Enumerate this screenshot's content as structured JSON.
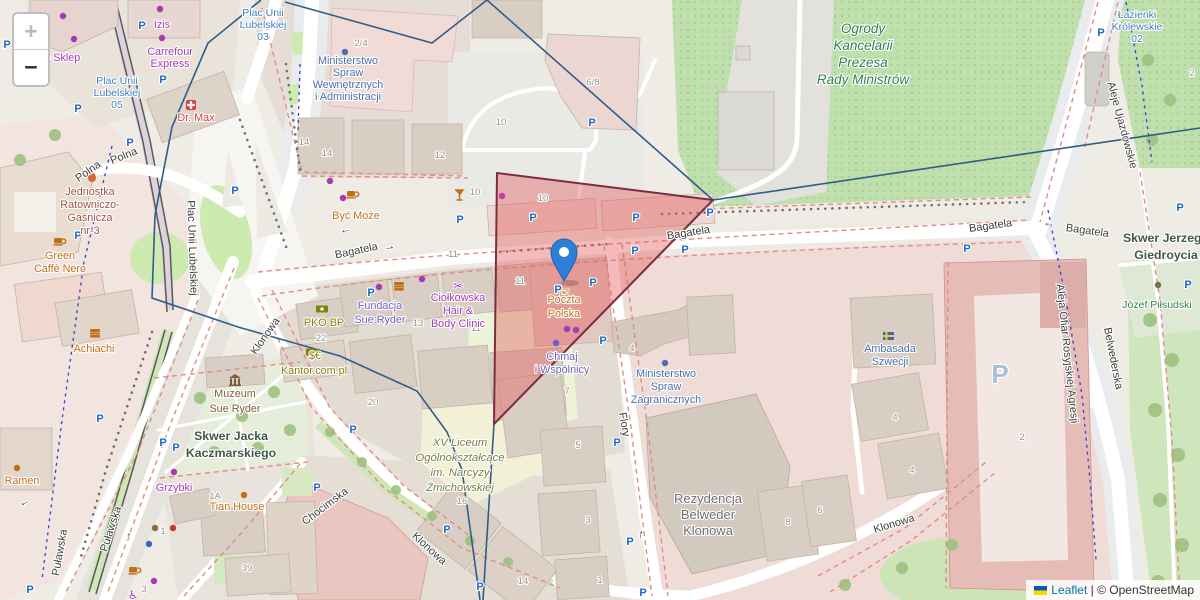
{
  "map": {
    "controls": {
      "zoom_in": "+",
      "zoom_out": "−"
    },
    "attribution": {
      "flag_icon": "ukraine-flag",
      "leaflet": "Leaflet",
      "separator": " | ",
      "osm": "© OpenStreetMap"
    },
    "marker": {
      "x": 564,
      "y": 281,
      "color": "#2e7fd6",
      "rim": "#1d62b4"
    },
    "red_polygon": {
      "points": "497,173 713,200 494,424",
      "fill": "#e25d5d",
      "fill_opacity": 0.42,
      "stroke": "#7c2d43"
    },
    "boundary": {
      "color": "#2f5d8a",
      "paths": [
        "M261,0 L208,43 L172,127 L155,215 L152,298 L238,327 L340,356 L417,391 L447,432 L462,470 L480,600",
        "M285,2 L432,43 L487,0",
        "M487,0 L713,200 L1200,128",
        "M713,200 L494,424 L483,600"
      ]
    },
    "labels": [
      {
        "lines": [
          "Plac Unii",
          "Lubelskiej",
          "03"
        ],
        "x": 263,
        "y": 16,
        "lh": 12,
        "cls": "transit"
      },
      {
        "lines": [
          "Plac Unii",
          "Lubelskiej",
          "05"
        ],
        "x": 117,
        "y": 84,
        "lh": 12,
        "cls": "transit"
      },
      {
        "lines": [
          "Łazienki",
          "Królewskie",
          "02"
        ],
        "x": 1137,
        "y": 18,
        "lh": 12,
        "cls": "transit"
      },
      {
        "t": "Zoo Sklep",
        "x": 56,
        "y": 61,
        "cls": "shop"
      },
      {
        "t": "Izis",
        "x": 162,
        "y": 28,
        "cls": "shop"
      },
      {
        "lines": [
          "Carrefour",
          "Express"
        ],
        "x": 170,
        "y": 55,
        "lh": 12,
        "cls": "shop"
      },
      {
        "lines": [
          "Fundacja",
          "Sue Ryder"
        ],
        "x": 380,
        "y": 309,
        "lh": 14,
        "cls": "office"
      },
      {
        "lines": [
          "Ciołkowska",
          "Hair &",
          "Body Clinic"
        ],
        "x": 458,
        "y": 301,
        "lh": 13,
        "cls": "shop"
      },
      {
        "t": "Grzybki",
        "x": 174,
        "y": 491,
        "cls": "shop"
      },
      {
        "lines": [
          "Chmaj",
          "i Wspólnicy"
        ],
        "x": 562,
        "y": 360,
        "lh": 13,
        "cls": "office"
      },
      {
        "t": "Być Może",
        "x": 356,
        "y": 219,
        "cls": "food"
      },
      {
        "lines": [
          "Green",
          "Caffè Nero"
        ],
        "x": 60,
        "y": 259,
        "lh": 13,
        "cls": "food"
      },
      {
        "t": "Achiachi",
        "x": 94,
        "y": 352,
        "cls": "food"
      },
      {
        "t": "Ramen",
        "x": 22,
        "y": 484,
        "cls": "food"
      },
      {
        "t": "Tian House",
        "x": 237,
        "y": 510,
        "cls": "food"
      },
      {
        "lines": [
          "Poczta",
          "Polska"
        ],
        "x": 564,
        "y": 303,
        "lh": 14,
        "cls": "food"
      },
      {
        "t": "PKO BP",
        "x": 324,
        "y": 326,
        "cls": "money"
      },
      {
        "t": "Kantor.com.pl",
        "x": 314,
        "y": 374,
        "cls": "money"
      },
      {
        "t": "$€",
        "x": 315,
        "y": 359,
        "cls": "money",
        "size": 9
      },
      {
        "t": "Dr. Max",
        "x": 196,
        "y": 121,
        "cls": "pharmacy"
      },
      {
        "lines": [
          "Jednostka",
          "Ratowniczo-",
          "Gaśnicza",
          "nr-3"
        ],
        "x": 90,
        "y": 195,
        "lh": 13,
        "cls": "fire"
      },
      {
        "lines": [
          "Ministerstwo",
          "Spraw",
          "Wewnętrznych",
          "i Administracji"
        ],
        "x": 348,
        "y": 64,
        "lh": 12,
        "cls": "gov"
      },
      {
        "lines": [
          "Ministerstwo",
          "Spraw",
          "Zagranicznych"
        ],
        "x": 666,
        "y": 377,
        "lh": 13,
        "cls": "gov"
      },
      {
        "lines": [
          "Ambasada",
          "Szwecji"
        ],
        "x": 890,
        "y": 352,
        "lh": 13,
        "cls": "gov"
      },
      {
        "lines": [
          "Ogrody",
          "Kancelarii",
          "Prezesa",
          "Rady Ministrów"
        ],
        "x": 863,
        "y": 33,
        "lh": 17,
        "cls": "parkbig"
      },
      {
        "t": "Józef Piłsudski",
        "x": 1157,
        "y": 308,
        "cls": "parksm"
      },
      {
        "lines": [
          "XV Liceum",
          "Ogólnokształcące",
          "im. Narcyzy",
          "Żmichowskiej"
        ],
        "x": 460,
        "y": 446,
        "lh": 15,
        "cls": "school"
      },
      {
        "lines": [
          "Skwer Jacka",
          "Kaczmarskiego"
        ],
        "x": 231,
        "y": 440,
        "lh": 17,
        "cls": "square"
      },
      {
        "lines": [
          "Skwer Jerzego",
          "Giedroycia"
        ],
        "x": 1166,
        "y": 242,
        "lh": 17,
        "cls": "square"
      },
      {
        "lines": [
          "Muzeum",
          "Sue Ryder"
        ],
        "x": 235,
        "y": 397,
        "lh": 15,
        "cls": "museum"
      },
      {
        "lines": [
          "Rezydencja",
          "Belweder",
          "Klonowa"
        ],
        "x": 708,
        "y": 503,
        "lh": 16,
        "cls": "residence"
      },
      {
        "t": "Polna",
        "x": 90,
        "y": 174,
        "rot": -35,
        "cls": "street"
      },
      {
        "t": "Polna",
        "x": 125,
        "y": 159,
        "rot": -22,
        "cls": "street"
      },
      {
        "t": "Plac Unii Lubelskiej",
        "x": 189,
        "y": 248,
        "rot": 88,
        "cls": "street"
      },
      {
        "t": "Bagatela",
        "x": 357,
        "y": 254,
        "rot": -12,
        "cls": "street"
      },
      {
        "t": "Bagatela",
        "x": 689,
        "y": 236,
        "rot": -9,
        "cls": "street"
      },
      {
        "t": "Bagatela",
        "x": 991,
        "y": 229,
        "rot": -8,
        "cls": "street"
      },
      {
        "t": "Bagatela",
        "x": 1087,
        "y": 234,
        "rot": 8,
        "cls": "street"
      },
      {
        "t": "Klonowa",
        "x": 268,
        "y": 338,
        "rot": -55,
        "cls": "street"
      },
      {
        "t": "Chocimska",
        "x": 327,
        "y": 509,
        "rot": -37,
        "cls": "street"
      },
      {
        "t": "Klonowa",
        "x": 427,
        "y": 551,
        "rot": 42,
        "cls": "street"
      },
      {
        "t": "Klonowa",
        "x": 895,
        "y": 527,
        "rot": -17,
        "cls": "street"
      },
      {
        "t": "Flory",
        "x": 621,
        "y": 425,
        "rot": 80,
        "cls": "street"
      },
      {
        "t": "Belwederska",
        "x": 1110,
        "y": 359,
        "rot": 79,
        "cls": "street"
      },
      {
        "t": "Aleje Ujazdowskie",
        "x": 1119,
        "y": 126,
        "rot": 75,
        "cls": "street"
      },
      {
        "t": "Aleja Ofiar Rosyjskiej Agresji",
        "x": 1064,
        "y": 354,
        "rot": 84,
        "cls": "street"
      },
      {
        "t": "Puławska",
        "x": 63,
        "y": 553,
        "rot": -80,
        "cls": "street"
      },
      {
        "t": "Puławska",
        "x": 114,
        "y": 530,
        "rot": -72,
        "cls": "street"
      },
      {
        "t": "→",
        "x": 390,
        "y": 250,
        "rot": -12,
        "cls": "arrow"
      },
      {
        "t": "←",
        "x": 346,
        "y": 233,
        "rot": -10,
        "cls": "arrow"
      },
      {
        "t": "←",
        "x": 1049,
        "y": 226,
        "cls": "arrow"
      },
      {
        "t": "←",
        "x": 26,
        "y": 505,
        "rot": -25,
        "cls": "arrow"
      },
      {
        "t": "↑",
        "x": 129,
        "y": 540,
        "cls": "arrow"
      },
      {
        "t": "↑",
        "x": 640,
        "y": 538,
        "rot": 12,
        "cls": "arrow"
      }
    ],
    "house_numbers": [
      {
        "t": "2/4",
        "x": 361,
        "y": 46
      },
      {
        "t": "14",
        "x": 304,
        "y": 145
      },
      {
        "t": "14",
        "x": 327,
        "y": 156
      },
      {
        "t": "12",
        "x": 440,
        "y": 158
      },
      {
        "t": "10",
        "x": 501,
        "y": 125
      },
      {
        "t": "6/8",
        "x": 593,
        "y": 85
      },
      {
        "t": "10",
        "x": 475,
        "y": 195
      },
      {
        "t": "10",
        "x": 543,
        "y": 201
      },
      {
        "t": "11",
        "x": 453,
        "y": 257
      },
      {
        "t": "11",
        "x": 520,
        "y": 284
      },
      {
        "t": "13",
        "x": 418,
        "y": 326
      },
      {
        "t": "11",
        "x": 476,
        "y": 331
      },
      {
        "t": "22",
        "x": 321,
        "y": 341
      },
      {
        "t": "20",
        "x": 373,
        "y": 405
      },
      {
        "t": "16",
        "x": 462,
        "y": 504
      },
      {
        "t": "1A",
        "x": 215,
        "y": 499
      },
      {
        "t": "1",
        "x": 163,
        "y": 534
      },
      {
        "t": "39",
        "x": 247,
        "y": 571
      },
      {
        "t": "3",
        "x": 144,
        "y": 592
      },
      {
        "t": "5",
        "x": 578,
        "y": 448
      },
      {
        "t": "3",
        "x": 588,
        "y": 523
      },
      {
        "t": "1",
        "x": 600,
        "y": 583
      },
      {
        "t": "8",
        "x": 788,
        "y": 525
      },
      {
        "t": "6",
        "x": 820,
        "y": 513
      },
      {
        "t": "4",
        "x": 895,
        "y": 420
      },
      {
        "t": "4",
        "x": 912,
        "y": 473
      },
      {
        "t": "4",
        "x": 632,
        "y": 351
      },
      {
        "t": "14",
        "x": 523,
        "y": 584
      },
      {
        "t": "2",
        "x": 1022,
        "y": 440
      },
      {
        "t": "2",
        "x": 1192,
        "y": 76
      },
      {
        "t": "7",
        "x": 567,
        "y": 394
      }
    ],
    "parking": [
      {
        "x": 7,
        "y": 48
      },
      {
        "x": 142,
        "y": 29
      },
      {
        "x": 163,
        "y": 83
      },
      {
        "x": 78,
        "y": 112
      },
      {
        "x": 130,
        "y": 146
      },
      {
        "x": 78,
        "y": 239
      },
      {
        "x": 235,
        "y": 194
      },
      {
        "x": 100,
        "y": 422
      },
      {
        "x": 163,
        "y": 446
      },
      {
        "x": 176,
        "y": 451
      },
      {
        "x": 30,
        "y": 593
      },
      {
        "x": 371,
        "y": 296
      },
      {
        "x": 460,
        "y": 223
      },
      {
        "x": 558,
        "y": 293
      },
      {
        "x": 533,
        "y": 221
      },
      {
        "x": 636,
        "y": 221
      },
      {
        "x": 635,
        "y": 254
      },
      {
        "x": 685,
        "y": 253
      },
      {
        "x": 710,
        "y": 216
      },
      {
        "x": 592,
        "y": 126
      },
      {
        "x": 593,
        "y": 286
      },
      {
        "x": 603,
        "y": 344
      },
      {
        "x": 353,
        "y": 433
      },
      {
        "x": 317,
        "y": 491
      },
      {
        "x": 447,
        "y": 533
      },
      {
        "x": 480,
        "y": 590
      },
      {
        "x": 617,
        "y": 446
      },
      {
        "x": 630,
        "y": 545
      },
      {
        "x": 643,
        "y": 596
      },
      {
        "x": 967,
        "y": 252
      },
      {
        "x": 1188,
        "y": 288
      },
      {
        "x": 1180,
        "y": 211
      },
      {
        "x": 1101,
        "y": 36
      },
      {
        "x": 1000,
        "y": 383,
        "big": true
      }
    ],
    "icons": [
      {
        "name": "shop-bag-icon",
        "shape": "dot",
        "x": 63,
        "y": 16,
        "color": "#a43bb3"
      },
      {
        "name": "paw-icon",
        "shape": "dot",
        "x": 74,
        "y": 39,
        "color": "#a43bb3"
      },
      {
        "name": "clothes-icon",
        "shape": "dot",
        "x": 160,
        "y": 9,
        "color": "#a43bb3"
      },
      {
        "name": "basket-icon",
        "shape": "dot",
        "x": 162,
        "y": 38,
        "color": "#a43bb3"
      },
      {
        "name": "pharmacy-cross-icon",
        "shape": "cross",
        "x": 191,
        "y": 105,
        "color": "#d43f3f"
      },
      {
        "name": "fire-flame-icon",
        "shape": "flame",
        "x": 92,
        "y": 176,
        "color": "#d9663c"
      },
      {
        "name": "coffee-cup-icon",
        "shape": "cup",
        "x": 59,
        "y": 241,
        "color": "#bf7017"
      },
      {
        "name": "tshirt-icon",
        "shape": "dot",
        "x": 330,
        "y": 181,
        "color": "#a43bb3"
      },
      {
        "name": "flower-icon",
        "shape": "dot",
        "x": 343,
        "y": 198,
        "color": "#a43bb3"
      },
      {
        "name": "coffee-cup-icon",
        "shape": "cup",
        "x": 352,
        "y": 194,
        "color": "#bf7017"
      },
      {
        "name": "money-icon",
        "shape": "money",
        "x": 322,
        "y": 309,
        "color": "#84800f"
      },
      {
        "name": "currency-icon",
        "shape": "money",
        "x": 312,
        "y": 352,
        "color": "#84800f"
      },
      {
        "name": "shopping-bag-icon",
        "shape": "dot",
        "x": 379,
        "y": 287,
        "color": "#a43bb3"
      },
      {
        "name": "burger-icon",
        "shape": "burger",
        "x": 399,
        "y": 286,
        "color": "#bf7017"
      },
      {
        "name": "scissors-icon",
        "shape": "glyph",
        "glyph": "✂",
        "x": 458,
        "y": 286,
        "color": "#a43bb3"
      },
      {
        "name": "poi-dot",
        "shape": "dot",
        "x": 422,
        "y": 279,
        "color": "#a43bb3"
      },
      {
        "name": "martini-icon",
        "shape": "martini",
        "x": 459,
        "y": 196,
        "color": "#bf7017"
      },
      {
        "name": "poi-dot",
        "shape": "dot",
        "x": 502,
        "y": 196,
        "color": "#c13bb3"
      },
      {
        "name": "envelope-icon",
        "shape": "glyph",
        "glyph": "✉",
        "x": 564,
        "y": 293,
        "color": "#c97b23"
      },
      {
        "name": "bottle-icon",
        "shape": "dot",
        "x": 567,
        "y": 329,
        "color": "#a43bb3"
      },
      {
        "name": "wine-icon",
        "shape": "dot",
        "x": 576,
        "y": 330,
        "color": "#a43bb3"
      },
      {
        "name": "poi-dot",
        "shape": "dot",
        "x": 556,
        "y": 343,
        "color": "#6e60c0"
      },
      {
        "name": "gov-dot",
        "shape": "dot",
        "x": 345,
        "y": 52,
        "color": "#4a6fae"
      },
      {
        "name": "gov-dot",
        "shape": "dot",
        "x": 665,
        "y": 363,
        "color": "#4a6fae"
      },
      {
        "name": "sweden-flag-icon",
        "shape": "flag",
        "x": 888,
        "y": 336,
        "color": "#3a66c4"
      },
      {
        "name": "museum-icon",
        "shape": "museum",
        "x": 235,
        "y": 380,
        "color": "#7c5b3a"
      },
      {
        "name": "statue-icon",
        "shape": "dot",
        "x": 1158,
        "y": 285,
        "color": "#6c7a4a"
      },
      {
        "name": "burger-icon",
        "shape": "burger",
        "x": 95,
        "y": 333,
        "color": "#bf7017"
      },
      {
        "name": "fork-icon",
        "shape": "dot",
        "x": 17,
        "y": 468,
        "color": "#bf7017"
      },
      {
        "name": "factory-icon",
        "shape": "dot",
        "x": 174,
        "y": 472,
        "color": "#a43bb3"
      },
      {
        "name": "bench-icon",
        "shape": "dot",
        "x": 155,
        "y": 528,
        "color": "#8a6d3a"
      },
      {
        "name": "chair-icon",
        "shape": "dot",
        "x": 173,
        "y": 528,
        "color": "#c0392b"
      },
      {
        "name": "utensils-icon",
        "shape": "dot",
        "x": 244,
        "y": 495,
        "color": "#bf7017"
      },
      {
        "name": "coffee-cup-icon",
        "shape": "cup",
        "x": 134,
        "y": 570,
        "color": "#bf7017"
      },
      {
        "name": "wheelchair-icon",
        "shape": "glyph",
        "glyph": "♿",
        "x": 133,
        "y": 595,
        "color": "#b03fb0"
      },
      {
        "name": "poi-dot",
        "shape": "dot",
        "x": 149,
        "y": 544,
        "color": "#3a66c4"
      },
      {
        "name": "poi-dot",
        "shape": "dot",
        "x": 154,
        "y": 581,
        "color": "#a43bb3"
      }
    ]
  }
}
